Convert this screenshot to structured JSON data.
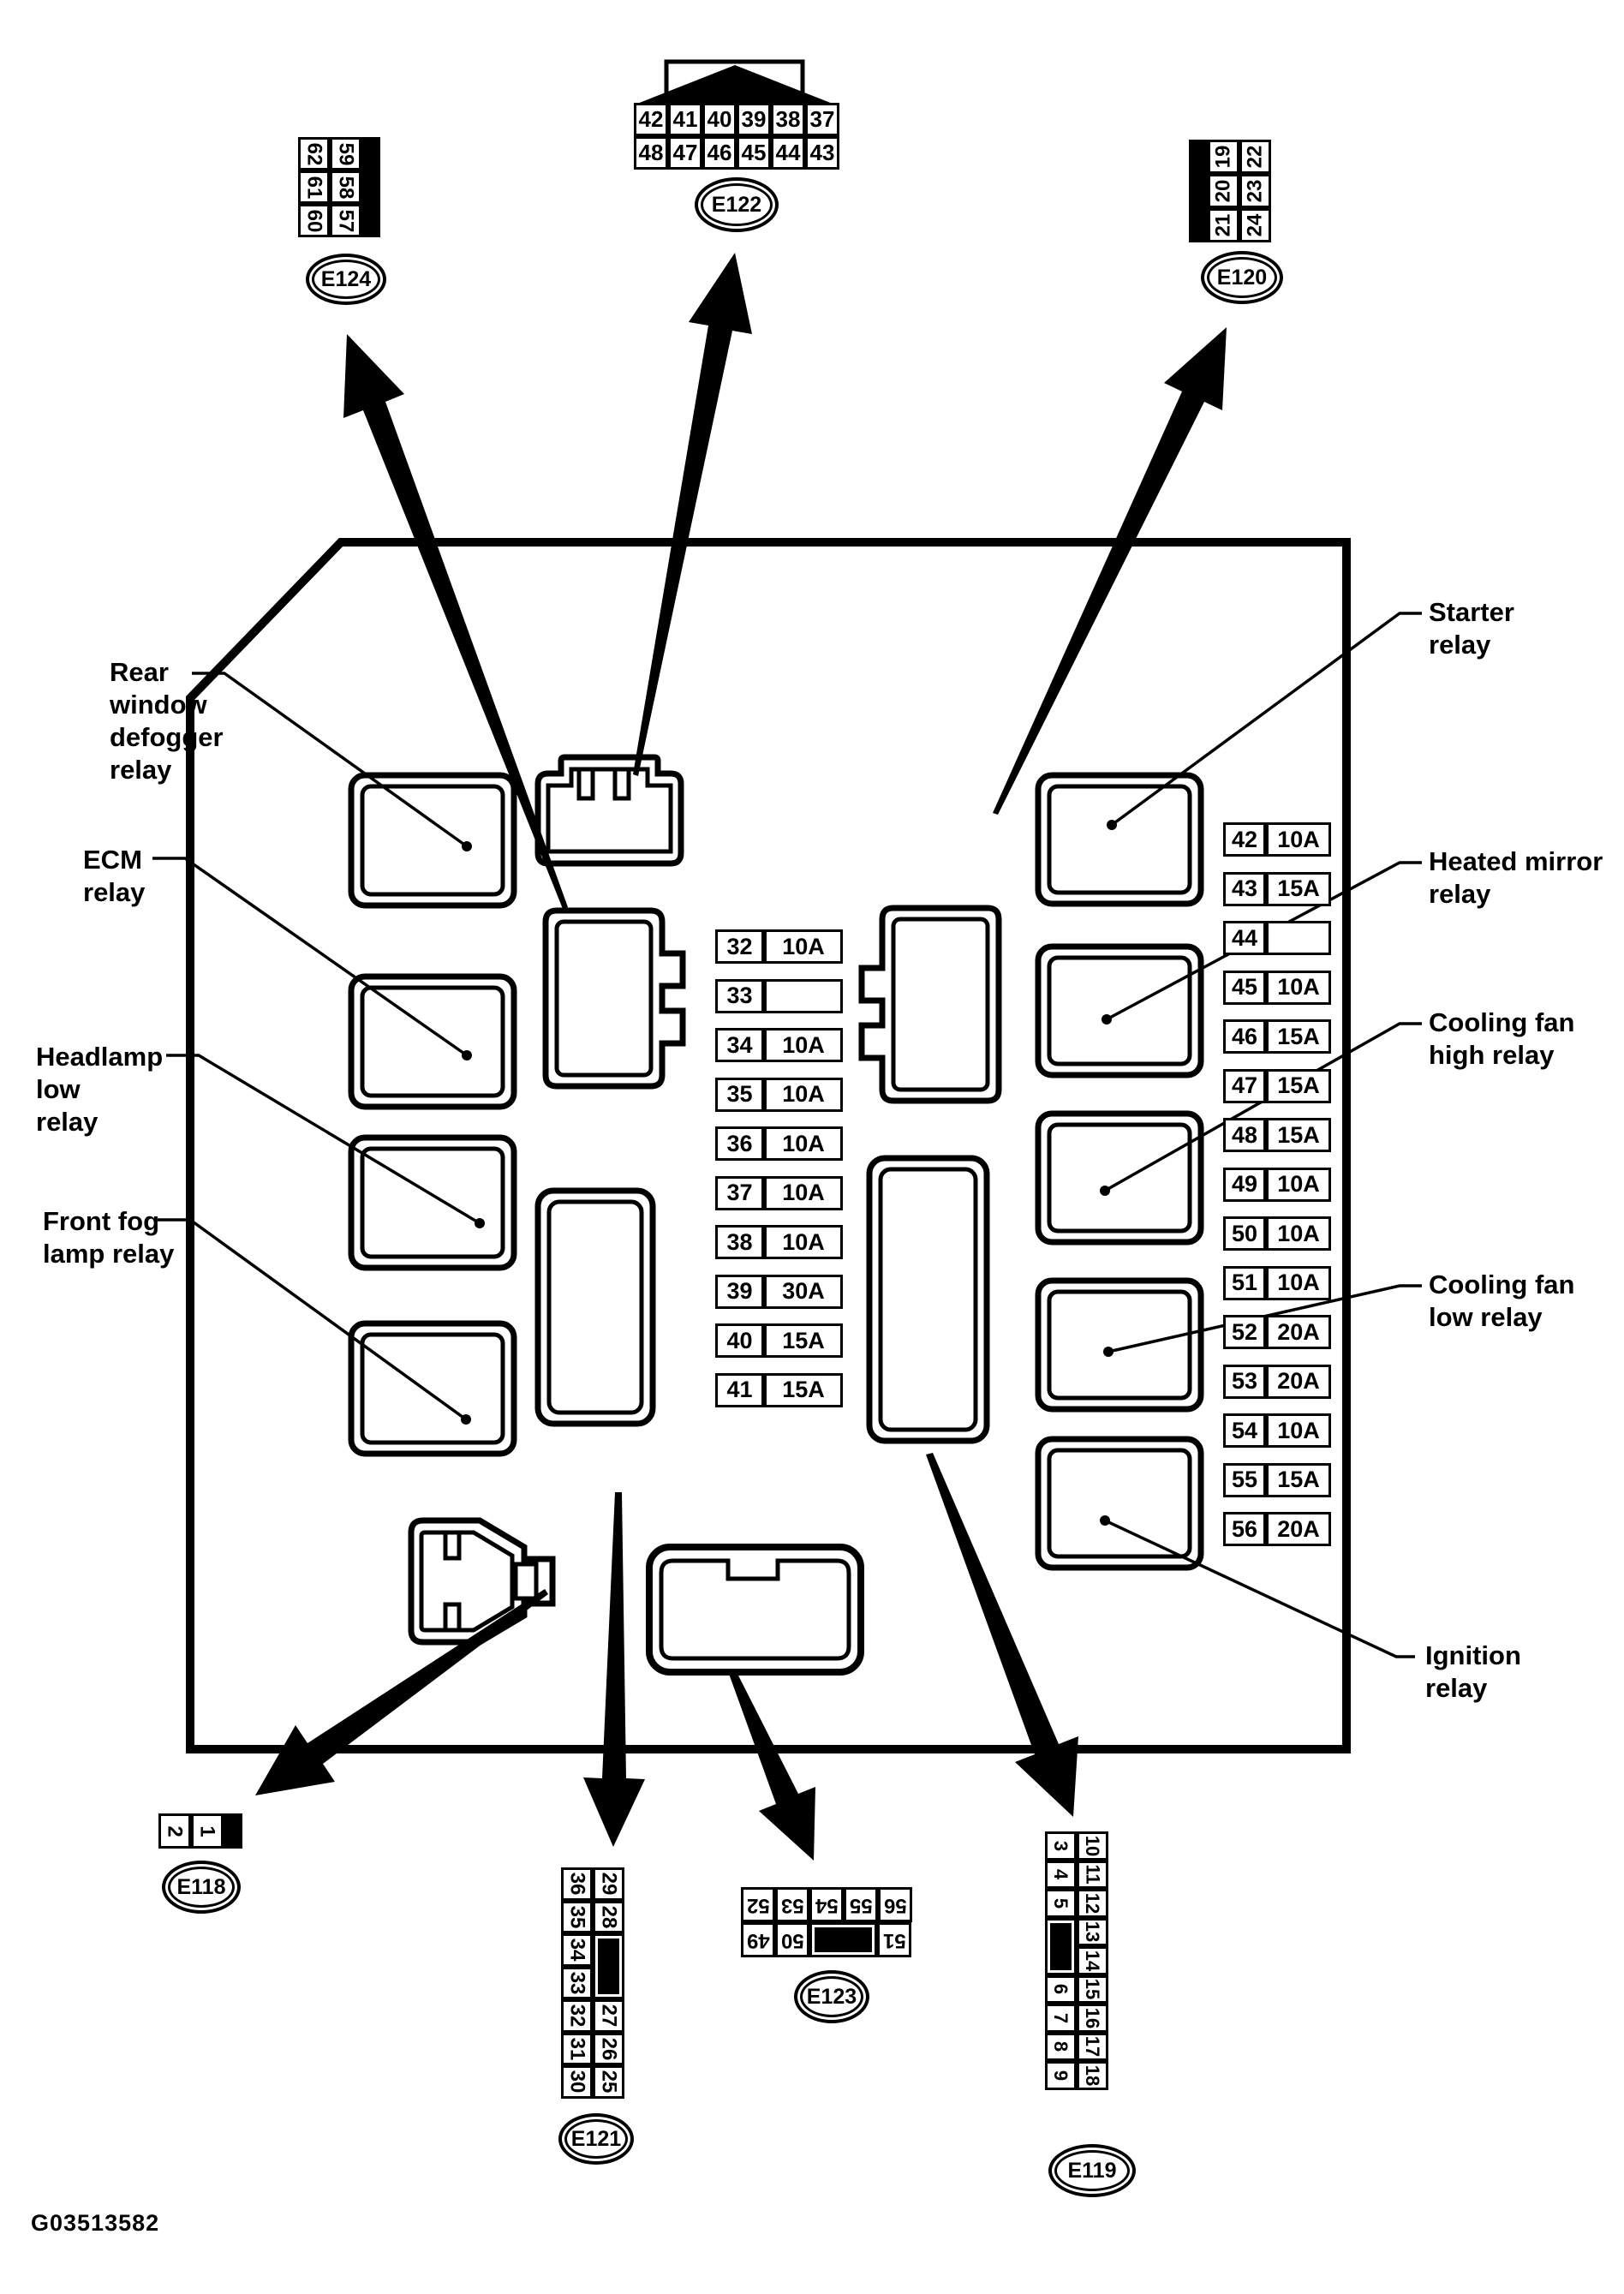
{
  "part_number": "G03513582",
  "colors": {
    "ink": "#000000",
    "paper": "#ffffff"
  },
  "labels": {
    "rear_window": "Rear\nwindow\ndefogger\nrelay",
    "ecm": "ECM\nrelay",
    "headlamp": "Headlamp\nlow\nrelay",
    "front_fog": "Front fog\nlamp relay",
    "starter": "Starter\nrelay",
    "heated_mirror": "Heated mirror\nrelay",
    "cooling_high": "Cooling fan\nhigh relay",
    "cooling_low": "Cooling fan\nlow relay",
    "ignition": "Ignition\nrelay"
  },
  "connectors": {
    "e124": {
      "name": "E124",
      "left": [
        {
          "n": "62"
        },
        {
          "n": "61"
        },
        {
          "n": "60"
        }
      ],
      "right": [
        {
          "n": "59"
        },
        {
          "n": "58"
        },
        {
          "n": "57"
        }
      ]
    },
    "e122": {
      "name": "E122",
      "row1": [
        {
          "n": "42"
        },
        {
          "n": "41"
        },
        {
          "n": "40"
        },
        {
          "n": "39"
        },
        {
          "n": "38"
        },
        {
          "n": "37"
        }
      ],
      "row2": [
        {
          "n": "48"
        },
        {
          "n": "47"
        },
        {
          "n": "46"
        },
        {
          "n": "45"
        },
        {
          "n": "44"
        },
        {
          "n": "43"
        }
      ]
    },
    "e120": {
      "name": "E120",
      "left": [
        {
          "n": "19"
        },
        {
          "n": "20"
        },
        {
          "n": "21"
        }
      ],
      "right": [
        {
          "n": "22"
        },
        {
          "n": "23"
        },
        {
          "n": "24"
        }
      ]
    },
    "e118": {
      "name": "E118",
      "row": [
        {
          "n": "2"
        },
        {
          "n": "1"
        }
      ]
    },
    "e121": {
      "name": "E121",
      "left": [
        {
          "n": "36"
        },
        {
          "n": "35"
        },
        {
          "n": "34"
        },
        {
          "n": "33"
        },
        {
          "n": "32"
        },
        {
          "n": "31"
        },
        {
          "n": "30"
        }
      ],
      "right": [
        {
          "n": "29"
        },
        {
          "n": "28"
        },
        {
          "n": "",
          "cls": "blk2"
        },
        {
          "n": "27"
        },
        {
          "n": "26"
        },
        {
          "n": "25"
        }
      ]
    },
    "e123": {
      "name": "E123",
      "row_top": [
        {
          "n": "52"
        },
        {
          "n": "53"
        },
        {
          "n": "54"
        },
        {
          "n": "55"
        },
        {
          "n": "56"
        }
      ],
      "row_bottom": [
        {
          "n": "49"
        },
        {
          "n": "50"
        },
        {
          "n": "",
          "cls": "blkw"
        },
        {
          "n": "51"
        }
      ]
    },
    "e119": {
      "name": "E119",
      "left": [
        {
          "n": "3"
        },
        {
          "n": "4"
        },
        {
          "n": "5"
        },
        {
          "n": "",
          "cls": "blk2"
        },
        {
          "n": "6"
        },
        {
          "n": "7"
        },
        {
          "n": "8"
        },
        {
          "n": "9"
        }
      ],
      "right": [
        {
          "n": "10"
        },
        {
          "n": "11"
        },
        {
          "n": "12"
        },
        {
          "n": "13"
        },
        {
          "n": "14"
        },
        {
          "n": "15"
        },
        {
          "n": "16"
        },
        {
          "n": "17"
        },
        {
          "n": "18"
        }
      ]
    }
  },
  "fuses": {
    "center": [
      {
        "id": "32",
        "amp": "10A"
      },
      {
        "id": "33",
        "amp": ""
      },
      {
        "id": "34",
        "amp": "10A"
      },
      {
        "id": "35",
        "amp": "10A"
      },
      {
        "id": "36",
        "amp": "10A"
      },
      {
        "id": "37",
        "amp": "10A"
      },
      {
        "id": "38",
        "amp": "10A"
      },
      {
        "id": "39",
        "amp": "30A"
      },
      {
        "id": "40",
        "amp": "15A"
      },
      {
        "id": "41",
        "amp": "15A"
      }
    ],
    "right": [
      {
        "id": "42",
        "amp": "10A"
      },
      {
        "id": "43",
        "amp": "15A"
      },
      {
        "id": "44",
        "amp": ""
      },
      {
        "id": "45",
        "amp": "10A"
      },
      {
        "id": "46",
        "amp": "15A"
      },
      {
        "id": "47",
        "amp": "15A"
      },
      {
        "id": "48",
        "amp": "15A"
      },
      {
        "id": "49",
        "amp": "10A"
      },
      {
        "id": "50",
        "amp": "10A"
      },
      {
        "id": "51",
        "amp": "10A"
      },
      {
        "id": "52",
        "amp": "20A"
      },
      {
        "id": "53",
        "amp": "20A"
      },
      {
        "id": "54",
        "amp": "10A"
      },
      {
        "id": "55",
        "amp": "15A"
      },
      {
        "id": "56",
        "amp": "20A"
      }
    ]
  }
}
